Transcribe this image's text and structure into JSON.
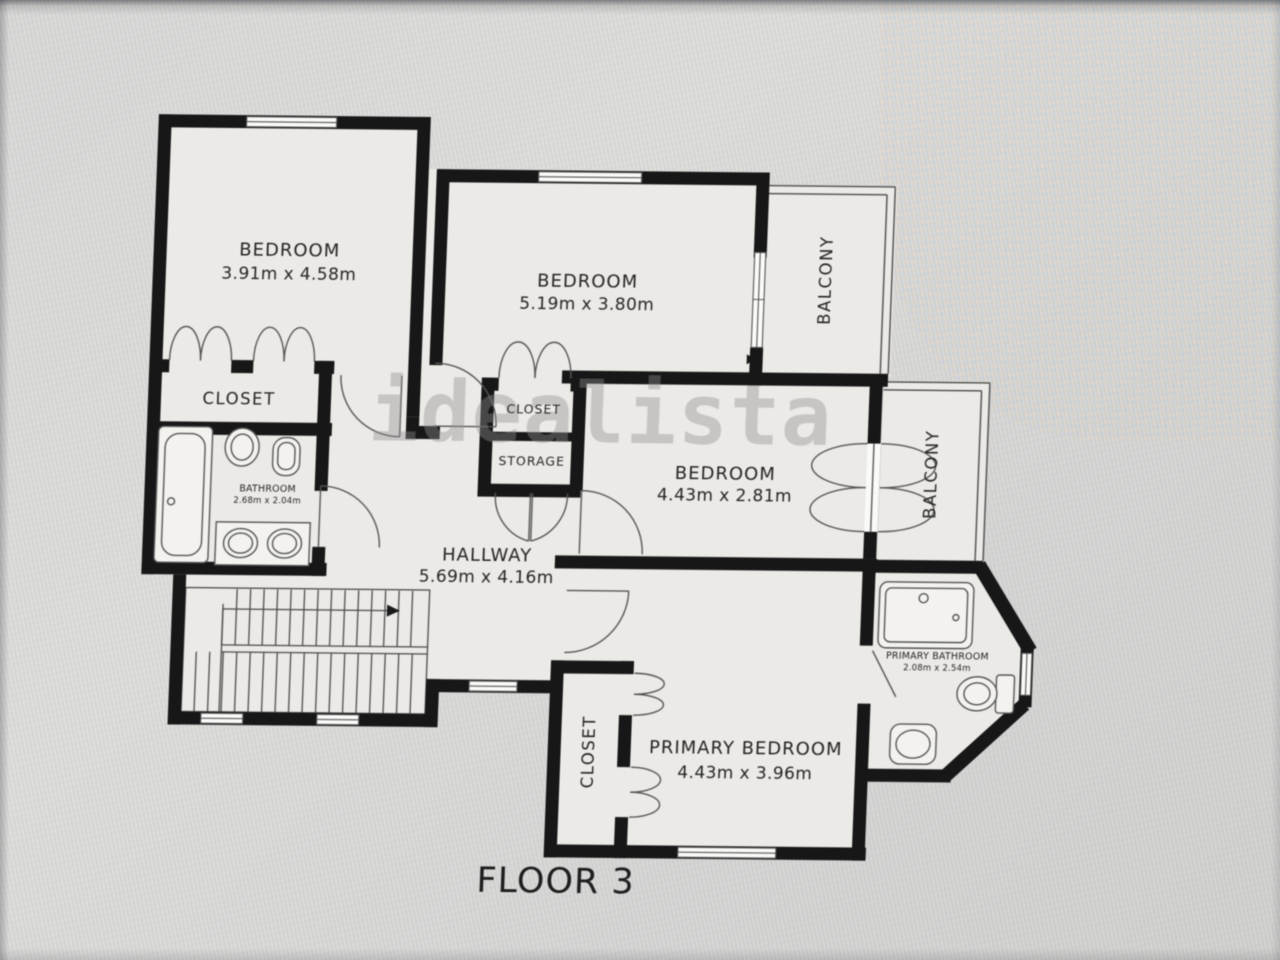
{
  "watermark": "idealista",
  "floor_label": "FLOOR 3",
  "rooms": {
    "bedroom1": {
      "name": "BEDROOM",
      "dims": "3.91m x 4.58m"
    },
    "bedroom2": {
      "name": "BEDROOM",
      "dims": "5.19m x 3.80m"
    },
    "bedroom3": {
      "name": "BEDROOM",
      "dims": "4.43m x 2.81m"
    },
    "primary_bedroom": {
      "name": "PRIMARY BEDROOM",
      "dims": "4.43m x 3.96m"
    },
    "hallway": {
      "name": "HALLWAY",
      "dims": "5.69m x 4.16m"
    },
    "bathroom": {
      "name": "BATHROOM",
      "dims": "2.68m x 2.04m"
    },
    "primary_bathroom": {
      "name": "PRIMARY BATHROOM",
      "dims": "2.08m x 2.54m"
    },
    "closet_bedroom1": {
      "name": "CLOSET"
    },
    "closet_hall": {
      "name": "CLOSET"
    },
    "storage": {
      "name": "STORAGE"
    },
    "closet_primary": {
      "name": "CLOSET"
    },
    "balcony_top": {
      "name": "BALCONY"
    },
    "balcony_right": {
      "name": "BALCONY"
    }
  }
}
